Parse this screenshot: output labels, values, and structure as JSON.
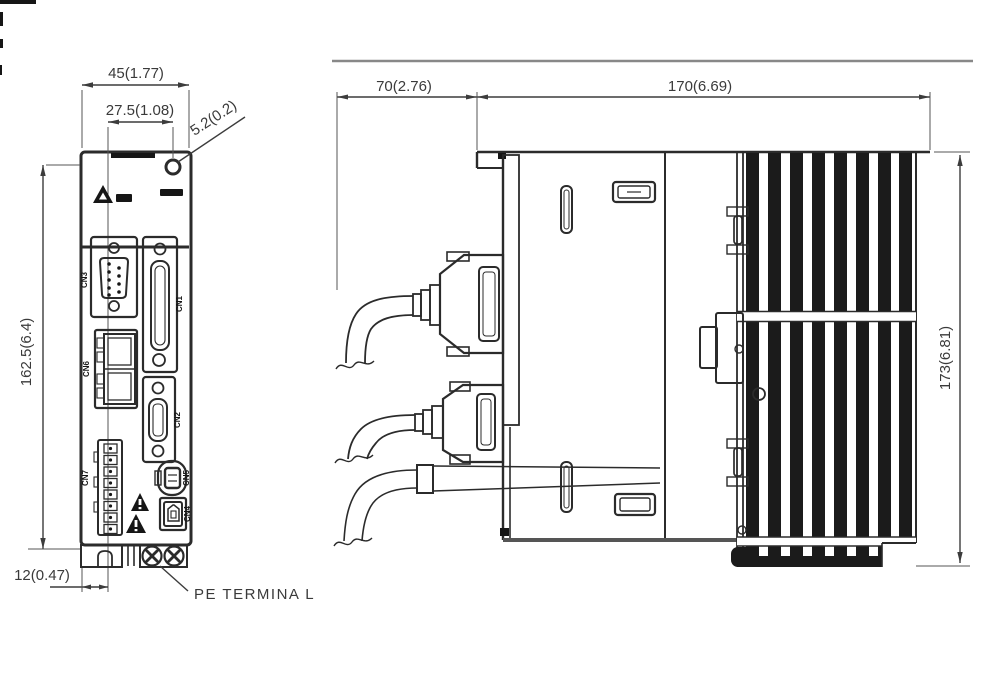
{
  "figure": {
    "type": "servo-drive-dimension-drawing",
    "front_view": {
      "dimensions": {
        "width": "45(1.77)",
        "hole_offset": "27.5(1.08)",
        "hole_diameter": "5.2(0.2)",
        "height": "162.5(6.4)",
        "notch_offset": "12(0.47)"
      },
      "labels": {
        "pe_terminal": "PE TERMINA L"
      },
      "connectors": [
        "CN3",
        "CN1",
        "CN6",
        "CN2",
        "CN7",
        "CN5",
        "CN4"
      ]
    },
    "side_view": {
      "dimensions": {
        "front_clearance": "70(2.76)",
        "depth": "170(6.69)",
        "height": "173(6.81)"
      }
    },
    "colors": {
      "line": "#2b2b2b",
      "dim_text": "#3a3a3a",
      "fin_dark": "#1b1b1b",
      "background": "#ffffff"
    }
  }
}
